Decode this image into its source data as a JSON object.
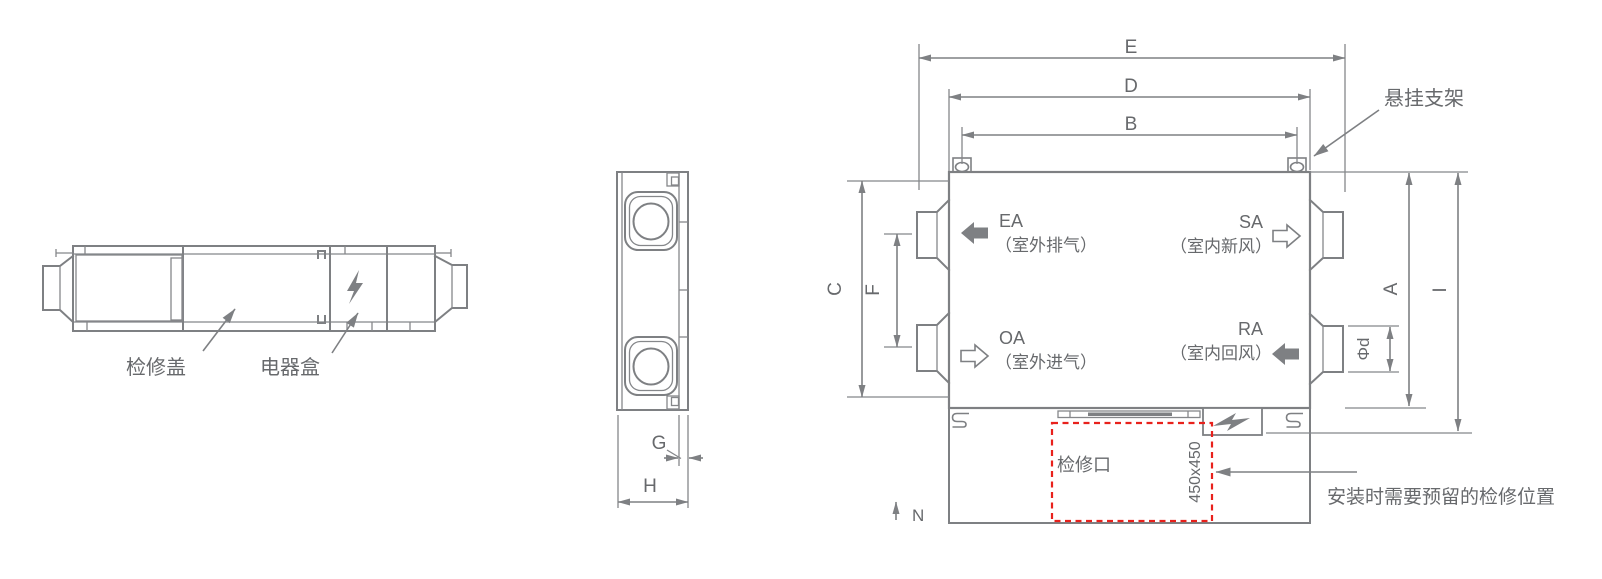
{
  "side_view": {
    "access_cover_label": "检修盖",
    "electrical_box_label": "电器盒"
  },
  "end_view": {
    "dim_g": "G",
    "dim_h": "H"
  },
  "plan_view": {
    "dim_e": "E",
    "dim_d": "D",
    "dim_b": "B",
    "dim_c": "C",
    "dim_f": "F",
    "dim_a": "A",
    "dim_i": "I",
    "dim_phi_d": "Φd",
    "north_label": "N",
    "port_ea_code": "EA",
    "port_ea_name": "（室外排气）",
    "port_sa_code": "SA",
    "port_sa_name": "（室内新风）",
    "port_oa_code": "OA",
    "port_oa_name": "（室外进气）",
    "port_ra_code": "RA",
    "port_ra_name": "（室内回风）",
    "hanging_bracket_label": "悬挂支架",
    "access_opening_label": "检修口",
    "access_opening_size": "450x450",
    "clearance_note": "安装时需要预留的检修位置"
  },
  "colors": {
    "line": "#7e8083",
    "text": "#67696c",
    "accent_red": "#e8211c"
  }
}
